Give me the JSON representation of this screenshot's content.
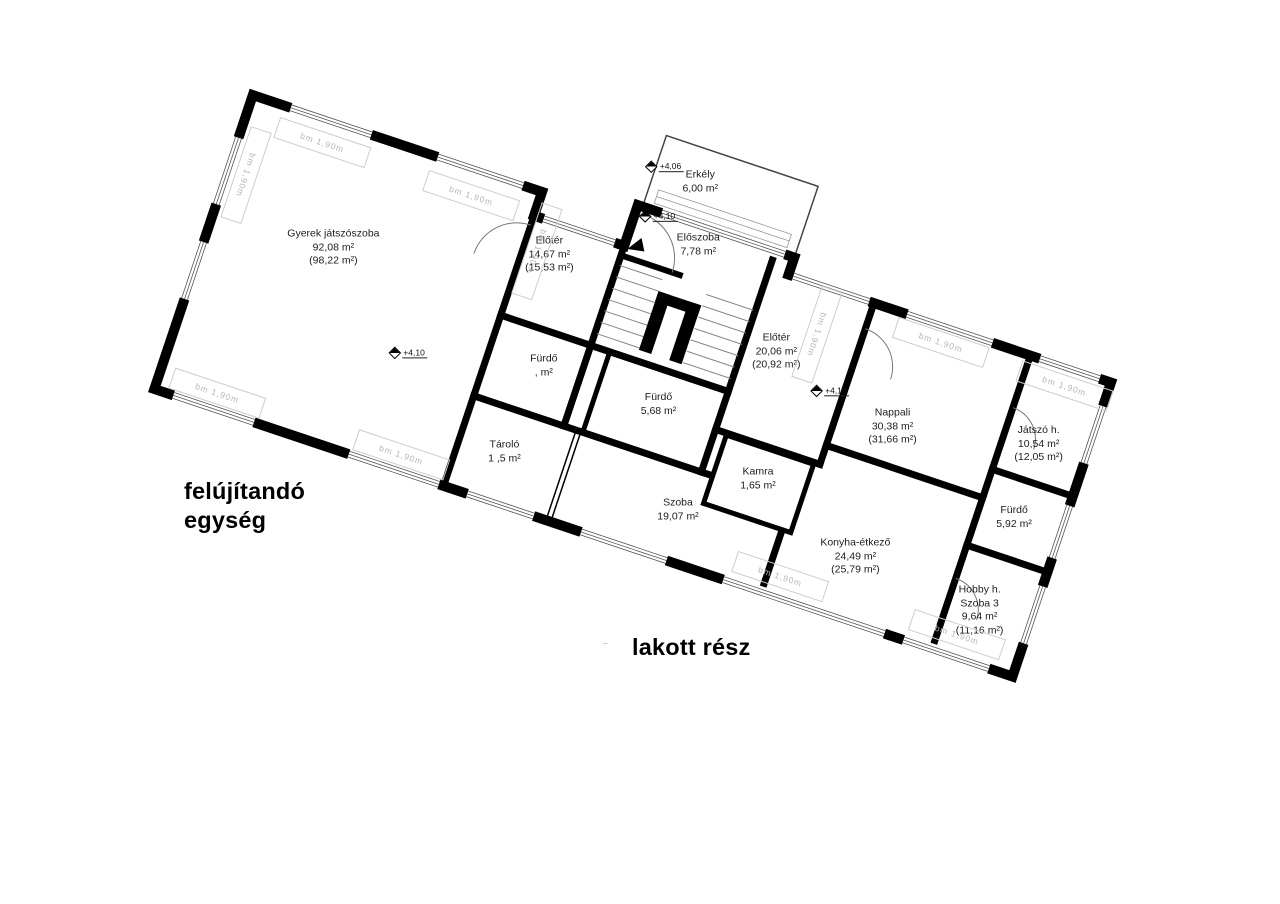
{
  "plan": {
    "rotation_deg": 18.52,
    "colors": {
      "wall": "#000000",
      "background": "#ffffff",
      "dim_text": "#b5b5b5",
      "thin_line": "#555555"
    },
    "window_label": "bm  1,90m",
    "captions": {
      "unit": "felújítandó egység",
      "occupied": "lakott rész",
      "tiny_mark": "‒"
    },
    "levels": [
      {
        "id": "erkely",
        "value": "+4,06"
      },
      {
        "id": "eloszoba",
        "value": "+4,10"
      },
      {
        "id": "gyerek",
        "value": "+4,10"
      },
      {
        "id": "nappali",
        "value": "+4,10"
      }
    ],
    "rooms": [
      {
        "key": "gyerek-jatszoszoba",
        "name": "Gyerek játszószoba",
        "area": "92,08 m²",
        "gross": "(98,22 m²)"
      },
      {
        "key": "eloter-14",
        "name": "Előtér",
        "area": "14,67 m²",
        "gross": "(15,53 m²)"
      },
      {
        "key": "erkely",
        "name": "Erkély",
        "area": "6,00 m²"
      },
      {
        "key": "eloszoba",
        "name": "Előszoba",
        "area": "7,78 m²"
      },
      {
        "key": "furdo-a",
        "name": "Fürdő",
        "area": ",  m²"
      },
      {
        "key": "furdo-b",
        "name": "Fürdő",
        "area": "5,68 m²"
      },
      {
        "key": "tarolo",
        "name": "Tároló",
        "area": "1 ,5 m²"
      },
      {
        "key": "szoba",
        "name": "Szoba",
        "area": "19,07 m²"
      },
      {
        "key": "kamra",
        "name": "Kamra",
        "area": "1,65 m²"
      },
      {
        "key": "eloter-20",
        "name": "Előtér",
        "area": "20,06 m²",
        "gross": "(20,92 m²)"
      },
      {
        "key": "nappali",
        "name": "Nappali",
        "area": "30,38 m²",
        "gross": "(31,66 m²)"
      },
      {
        "key": "konyha-etkezo",
        "name": "Konyha-étkező",
        "area": "24,49 m²",
        "gross": "(25,79 m²)"
      },
      {
        "key": "jatszo-h",
        "name": "Játszó h.",
        "area": "10,54 m²",
        "gross": "(12,05 m²)"
      },
      {
        "key": "furdo-c",
        "name": "Fürdő",
        "area": "5,92 m²"
      },
      {
        "key": "hobby-h",
        "name": "Hobby h.",
        "name2": "Szoba 3",
        "area": "9,64 m²",
        "gross": "(11,16 m²)"
      }
    ]
  }
}
